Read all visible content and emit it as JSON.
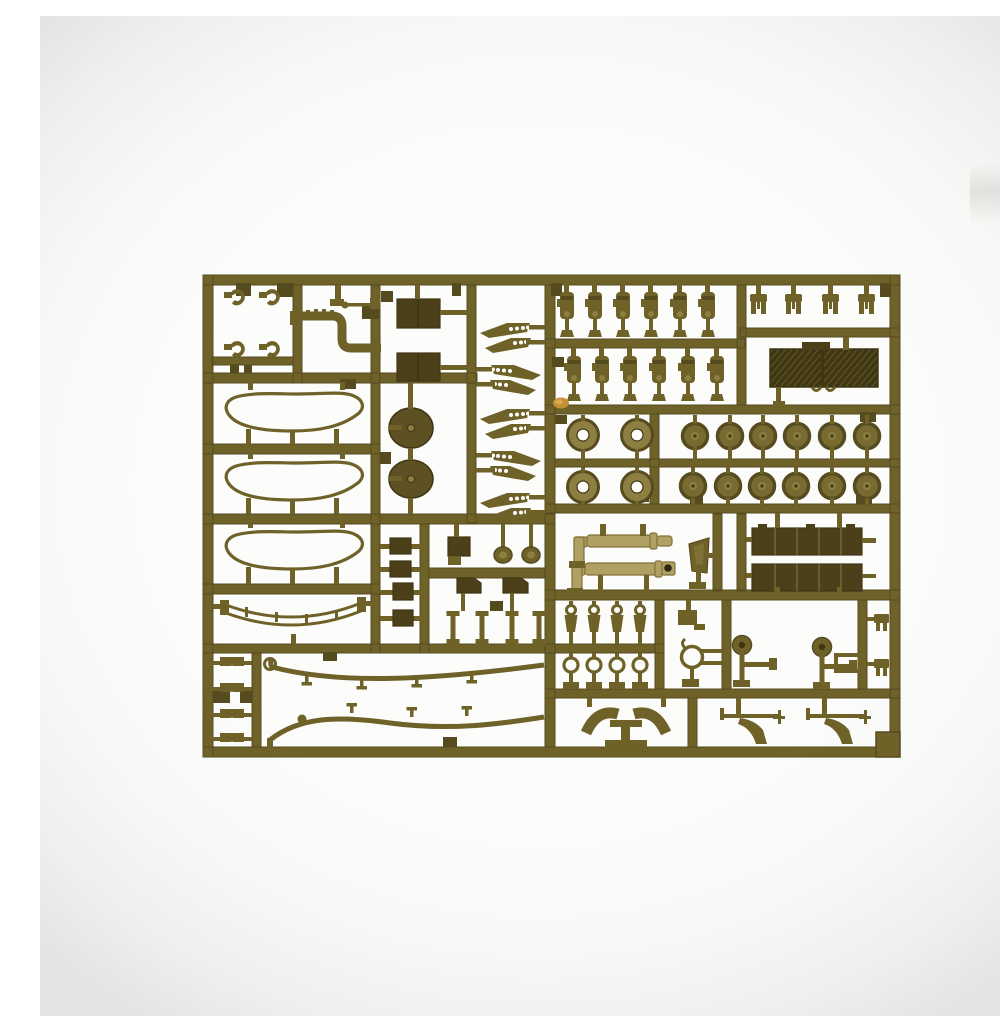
{
  "meta": {
    "type": "product-photo",
    "description": "Photograph of an olive-drab injection-molded plastic model kit sprue (parts tree) lying on a plain white studio background with soft grey vignette at the edges",
    "subject": "model kit sprue with unassembled tank parts",
    "background": "plain white, no text or labels visible"
  },
  "colors": {
    "bg": "#fcfcfb",
    "vignette": "#e4e4e2",
    "sprue": "#6e6229",
    "sprue-dark": "#564b1f",
    "sprue-darker": "#3f3614",
    "part-dark": "#4b4019",
    "sprue-light": "#8d7f41",
    "wheel": "#776b31",
    "tan": "#b0a063",
    "tan-dark": "#837238",
    "orange": "#c69136",
    "hole": "#fcfcfb"
  },
  "sprue": {
    "color_name": "olive drab",
    "bounds_px": {
      "left": 163,
      "top": 259,
      "right": 860,
      "bottom": 741
    },
    "parts_groups": [
      {
        "name": "tow-hooks",
        "count": 4,
        "area": "top-left compartment"
      },
      {
        "name": "bent-exhaust-pipe",
        "count": 1,
        "area": "top-left, second compartment"
      },
      {
        "name": "gear-lever",
        "count": 1,
        "area": "beside exhaust pipe"
      },
      {
        "name": "hatch-panels",
        "count": 2,
        "area": "top, third column"
      },
      {
        "name": "perforated-fender-tips",
        "count": 10,
        "area": "tall narrow compartment, top centre-left"
      },
      {
        "name": "shock-absorbers",
        "count": 12,
        "area": "top centre, two rows of six"
      },
      {
        "name": "clevis-forks",
        "count": 4,
        "area": "top-right row"
      },
      {
        "name": "engine-grille-panel",
        "count": 1,
        "area": "top-right, dark hatched block"
      },
      {
        "name": "hull-tub-rims",
        "count": 3,
        "area": "left side, three oval outlines"
      },
      {
        "name": "curved-track-guard",
        "count": 1,
        "area": "left side below ovals"
      },
      {
        "name": "final-drive-housings",
        "count": 2,
        "area": "centre-left dark rounded blobs"
      },
      {
        "name": "idler-wheels",
        "count": 4,
        "area": "centre, ring wheels with open hubs"
      },
      {
        "name": "road-wheels",
        "count": 12,
        "area": "centre-right, two rows of six"
      },
      {
        "name": "gun-barrels",
        "count": 2,
        "area": "centre, tan L-shaped tubes"
      },
      {
        "name": "sight-shield",
        "count": 1,
        "area": "right of gun barrels"
      },
      {
        "name": "stowage-racks",
        "count": 2,
        "area": "right, long dark segmented boxes"
      },
      {
        "name": "small-blocks",
        "count": 4,
        "area": "centre column"
      },
      {
        "name": "small-fittings",
        "count": 9,
        "area": "centre compartment: panel, hub caps, chamfered boxes, struts"
      },
      {
        "name": "towing-shackles",
        "count": 4,
        "area": "centre-bottom row"
      },
      {
        "name": "eyelet-rings",
        "count": 4,
        "area": "centre-bottom row"
      },
      {
        "name": "clamp-ring",
        "count": 1,
        "area": "bottom centre-right"
      },
      {
        "name": "rear-view-mirrors",
        "count": 2,
        "area": "bottom right band"
      },
      {
        "name": "frame-bracket",
        "count": 1,
        "area": "bottom right band"
      },
      {
        "name": "small-forks",
        "count": 2,
        "area": "bottom right edge column"
      },
      {
        "name": "seat-horns",
        "count": 1,
        "area": "bottom centre pedestal part"
      },
      {
        "name": "fender-brackets",
        "count": 2,
        "area": "bottom right compartment"
      },
      {
        "name": "tow-cables",
        "count": 2,
        "area": "large bottom-left compartment"
      },
      {
        "name": "angle-brackets",
        "count": 8,
        "area": "bottom-left twin columns"
      },
      {
        "name": "corner-block",
        "count": 1,
        "area": "bottom-right corner of frame"
      },
      {
        "name": "molding-flash",
        "count": 1,
        "area": "small orange resin flash left of centre"
      }
    ]
  }
}
